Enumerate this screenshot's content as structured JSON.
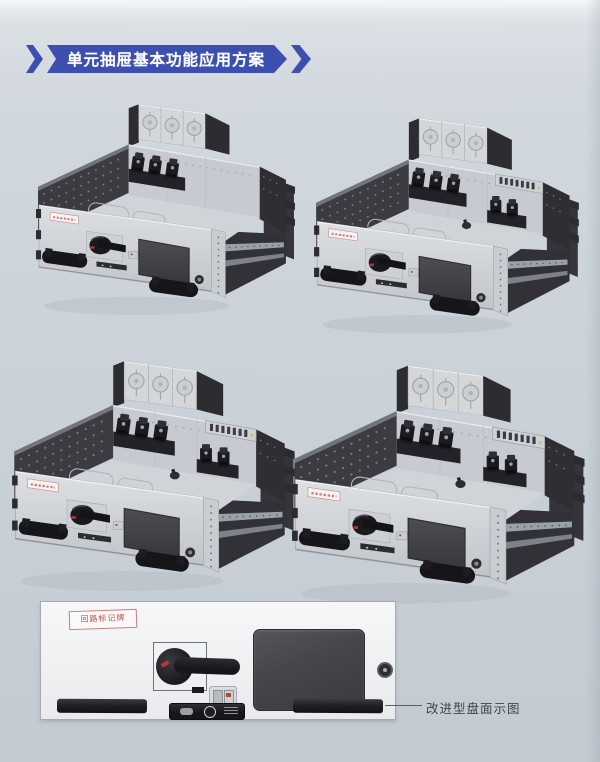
{
  "page": {
    "bg_top": "#eef0f2",
    "bg_main": "#ccd3da"
  },
  "banner": {
    "title": "单元抽屉基本功能应用方案",
    "color": "#3c4fb1",
    "text_color": "#ffffff"
  },
  "units": [
    {
      "name": "drawer-unit-figure-1",
      "variant": "basic"
    },
    {
      "name": "drawer-unit-figure-2",
      "variant": "extended"
    },
    {
      "name": "drawer-unit-figure-3",
      "variant": "extended"
    },
    {
      "name": "drawer-unit-figure-4",
      "variant": "extended"
    }
  ],
  "panel_diagram": {
    "corner_label": "回路标记牌",
    "corner_label_color": "#c0504d",
    "caption": "改进型盘面示图"
  }
}
